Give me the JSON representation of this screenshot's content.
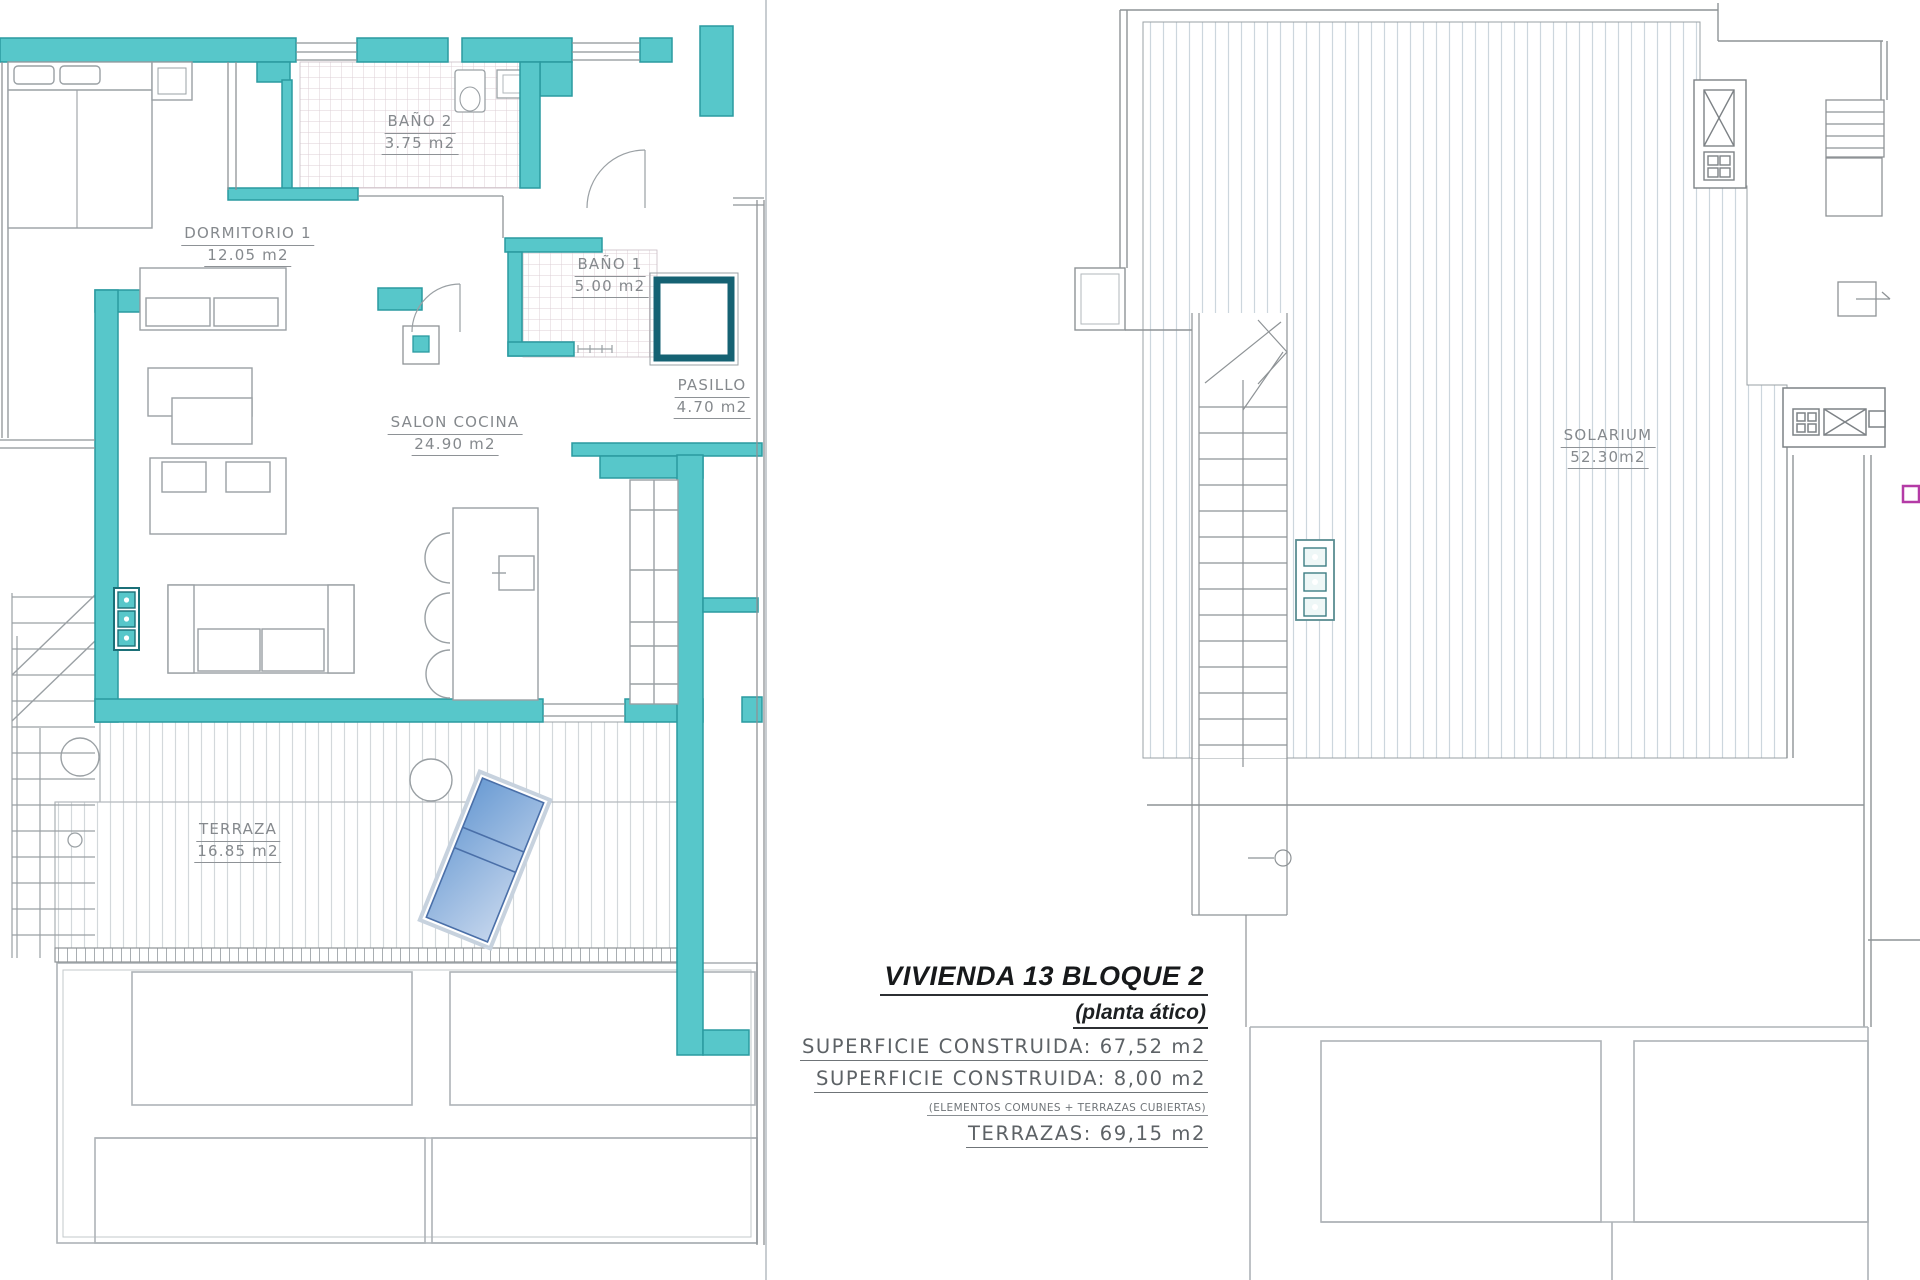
{
  "left_plan": {
    "rooms": [
      {
        "name": "DORMITORIO 1",
        "area": "12.05 m2"
      },
      {
        "name": "BAÑO 2",
        "area": "3.75 m2"
      },
      {
        "name": "BAÑO 1",
        "area": "5.00 m2"
      },
      {
        "name": "SALON COCINA",
        "area": "24.90 m2"
      },
      {
        "name": "PASILLO",
        "area": "4.70 m2"
      },
      {
        "name": "TERRAZA",
        "area": "16.85 m2"
      }
    ]
  },
  "right_plan": {
    "rooms": [
      {
        "name": "SOLARIUM",
        "area": "52.30m2"
      }
    ]
  },
  "title_block": {
    "title": "VIVIENDA 13 BLOQUE 2",
    "subtitle": "(planta ático)",
    "surface1_label": "SUPERFICIE CONSTRUIDA:",
    "surface1_value": "67,52 m2",
    "surface2_label": "SUPERFICIE CONSTRUIDA:",
    "surface2_value": "8,00 m2",
    "surface2_note": "(ELEMENTOS COMUNES + TERRAZAS CUBIERTAS)",
    "terrazas_label": "TERRAZAS:",
    "terrazas_value": "69,15 m2"
  },
  "colors": {
    "wall_fill": "#57c7ca",
    "wall_stroke": "#2a9aa0",
    "shower_stroke": "#156273",
    "lounger_fill": "#7fa9db",
    "terrace_hatch_line": "#d3d8db",
    "solarium_hatch_line": "#ccd6dd",
    "bath_grid_line": "#dccfd6",
    "drawing_line_gray": "#8e9396",
    "sheet_divider": "#c8cdd1",
    "accent_pink": "#b43ba6"
  }
}
